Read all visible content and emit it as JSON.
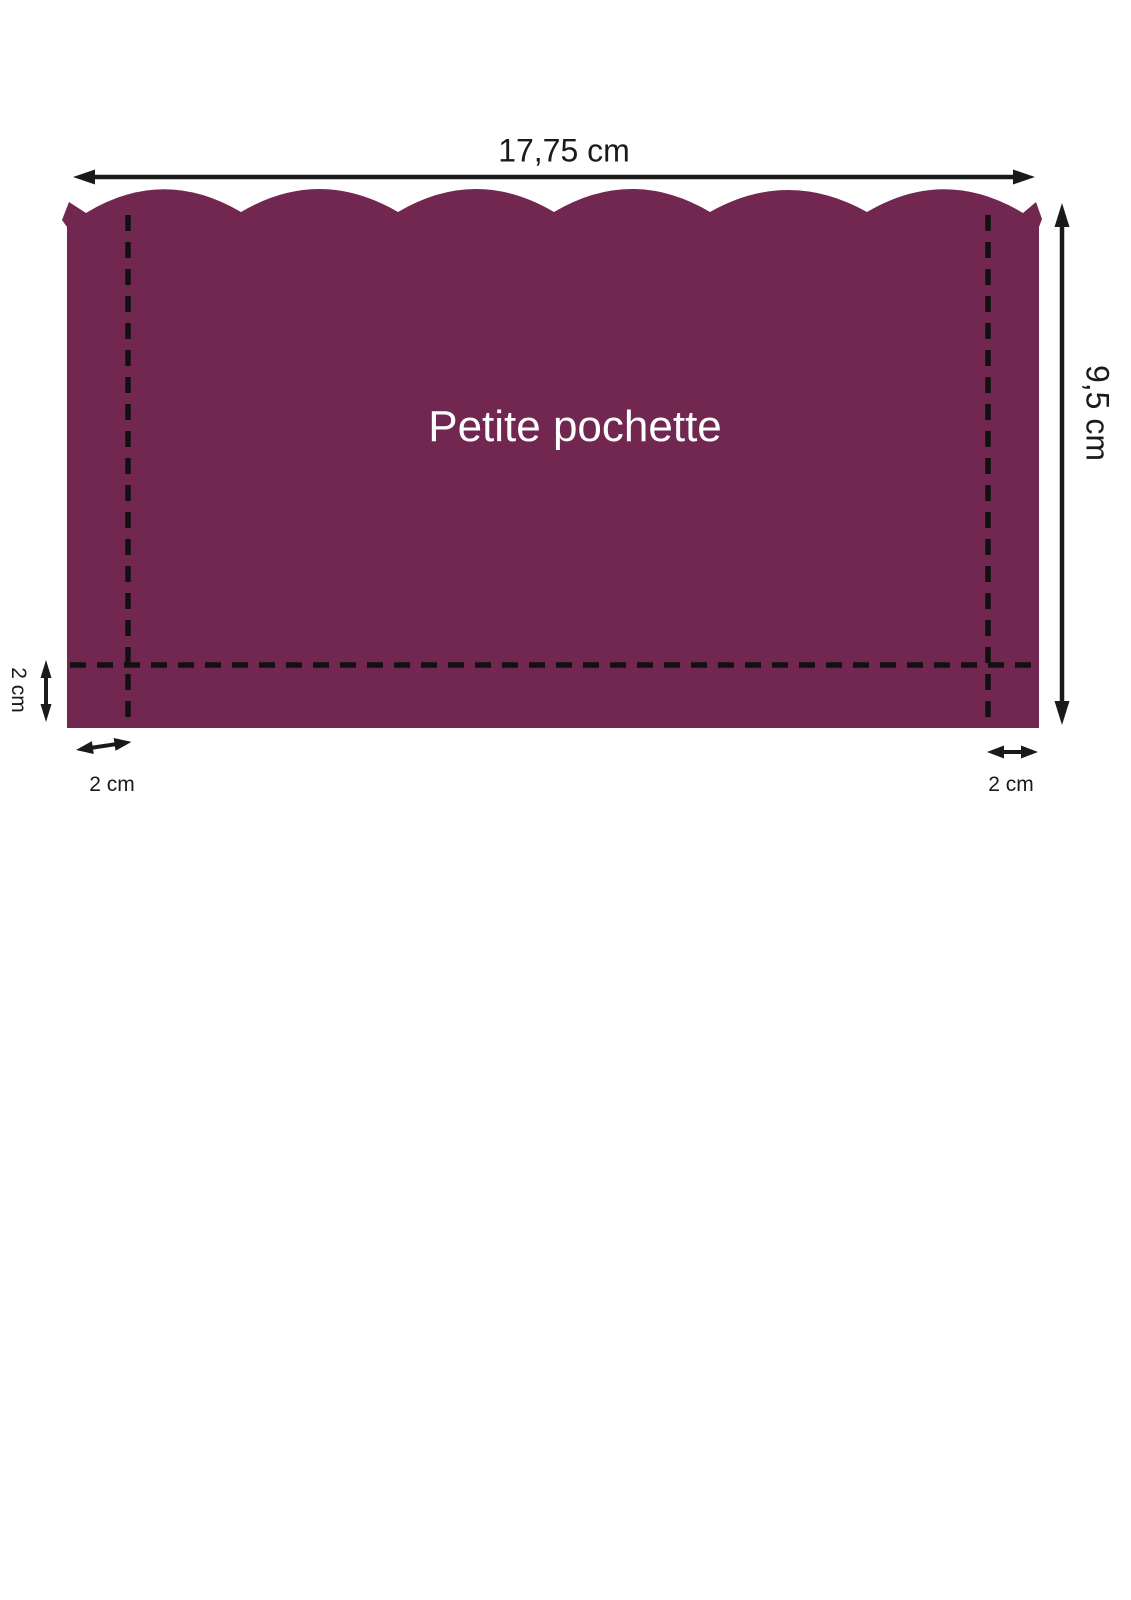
{
  "diagram": {
    "title": "Petite pochette",
    "labels": {
      "width": "17,75 cm",
      "height": "9,5 cm",
      "seam_left": "2 cm",
      "seam_bottom_left": "2 cm",
      "seam_bottom_right": "2 cm"
    },
    "colors": {
      "shape_fill": "#722750",
      "line_color": "#1a1a1a",
      "title_color": "#ffffff",
      "background": "#ffffff"
    },
    "shape": {
      "scallop_count": 6,
      "seam_line_style": "dashed"
    }
  }
}
